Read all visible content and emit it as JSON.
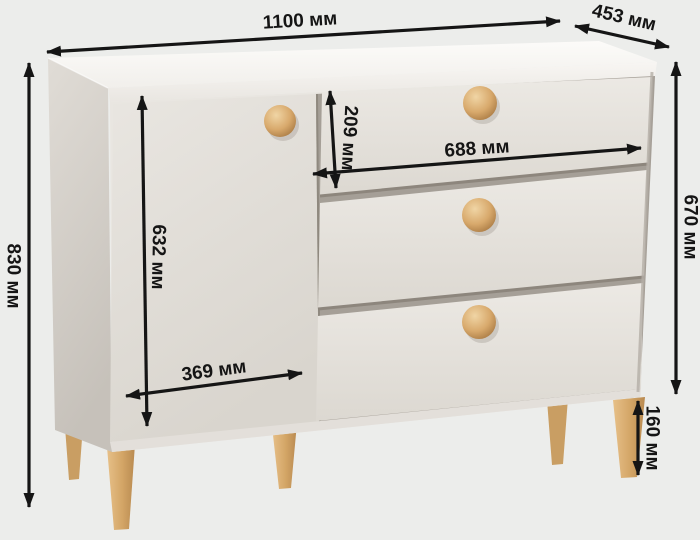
{
  "diagram": {
    "type": "furniture-dimension-diagram",
    "subject": "chest of drawers with one door, three drawers, round wooden knobs and tapered wooden legs",
    "unit": "мм",
    "dimensions": {
      "overall_width": {
        "value": 1100,
        "label": "1100 мм"
      },
      "depth": {
        "value": 453,
        "label": "453 мм"
      },
      "overall_height": {
        "value": 830,
        "label": "830 мм"
      },
      "door_height": {
        "value": 632,
        "label": "632 мм"
      },
      "door_width": {
        "value": 369,
        "label": "369 мм"
      },
      "top_drawer_height": {
        "value": 209,
        "label": "209 мм"
      },
      "drawer_width": {
        "value": 688,
        "label": "688 мм"
      },
      "carcass_height": {
        "value": 670,
        "label": "670 мм"
      },
      "leg_height": {
        "value": 160,
        "label": "160 мм"
      }
    },
    "colors": {
      "background": "#ecedeb",
      "dimension_lines": "#151515",
      "body_light": "#f5f3ef",
      "body_shade": "#c9c4bd",
      "wood_accent": "#d5a76b"
    }
  }
}
